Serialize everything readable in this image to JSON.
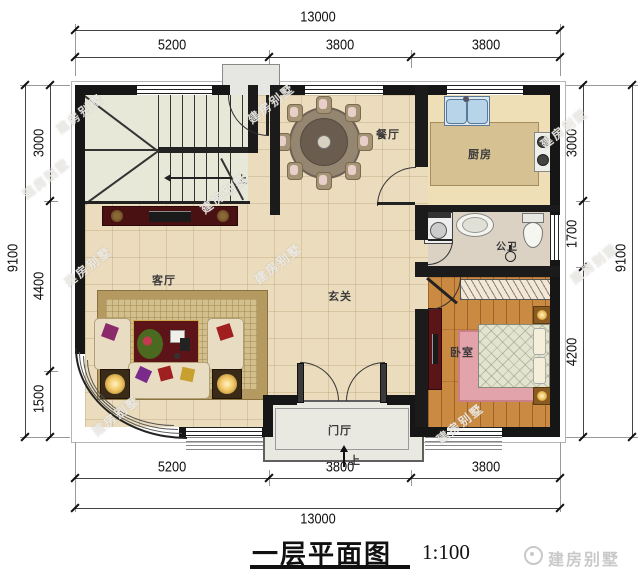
{
  "title": {
    "text": "一层平面图",
    "scale": "1:100"
  },
  "brand": {
    "name": "建房别墅"
  },
  "watermark": {
    "text": "建房别墅"
  },
  "dims": {
    "top": {
      "total": "13000",
      "segments": [
        "5200",
        "3800",
        "3800"
      ]
    },
    "bottom": {
      "total": "13000",
      "segments": [
        "5200",
        "3800",
        "3800"
      ]
    },
    "left": {
      "total": "9100",
      "segments": [
        "3000",
        "4400",
        "1500"
      ]
    },
    "right": {
      "total": "9100",
      "segments": [
        "3000",
        "1700",
        "4200"
      ]
    }
  },
  "rooms": {
    "dining": "餐厅",
    "kitchen": "厨房",
    "bath": "公卫",
    "bedroom": "卧室",
    "living": "客厅",
    "foyer": "玄关",
    "porch": "门厅"
  },
  "stairs": {
    "up": "上"
  },
  "entry": {
    "up": "上"
  },
  "colors": {
    "wall": "#161616",
    "tile_floor": "#ebdcbd",
    "wood_floor": "#ca8a41",
    "stair_floor": "#e7e8d8",
    "kitchen_floor": "#eedfb6",
    "bath_floor": "#dbd2c4",
    "rug_gold": "#b49a60",
    "rug_pink": "#e2a3ab",
    "accent_red": "#5c1418",
    "sink_blue": "#b8d4e8"
  }
}
